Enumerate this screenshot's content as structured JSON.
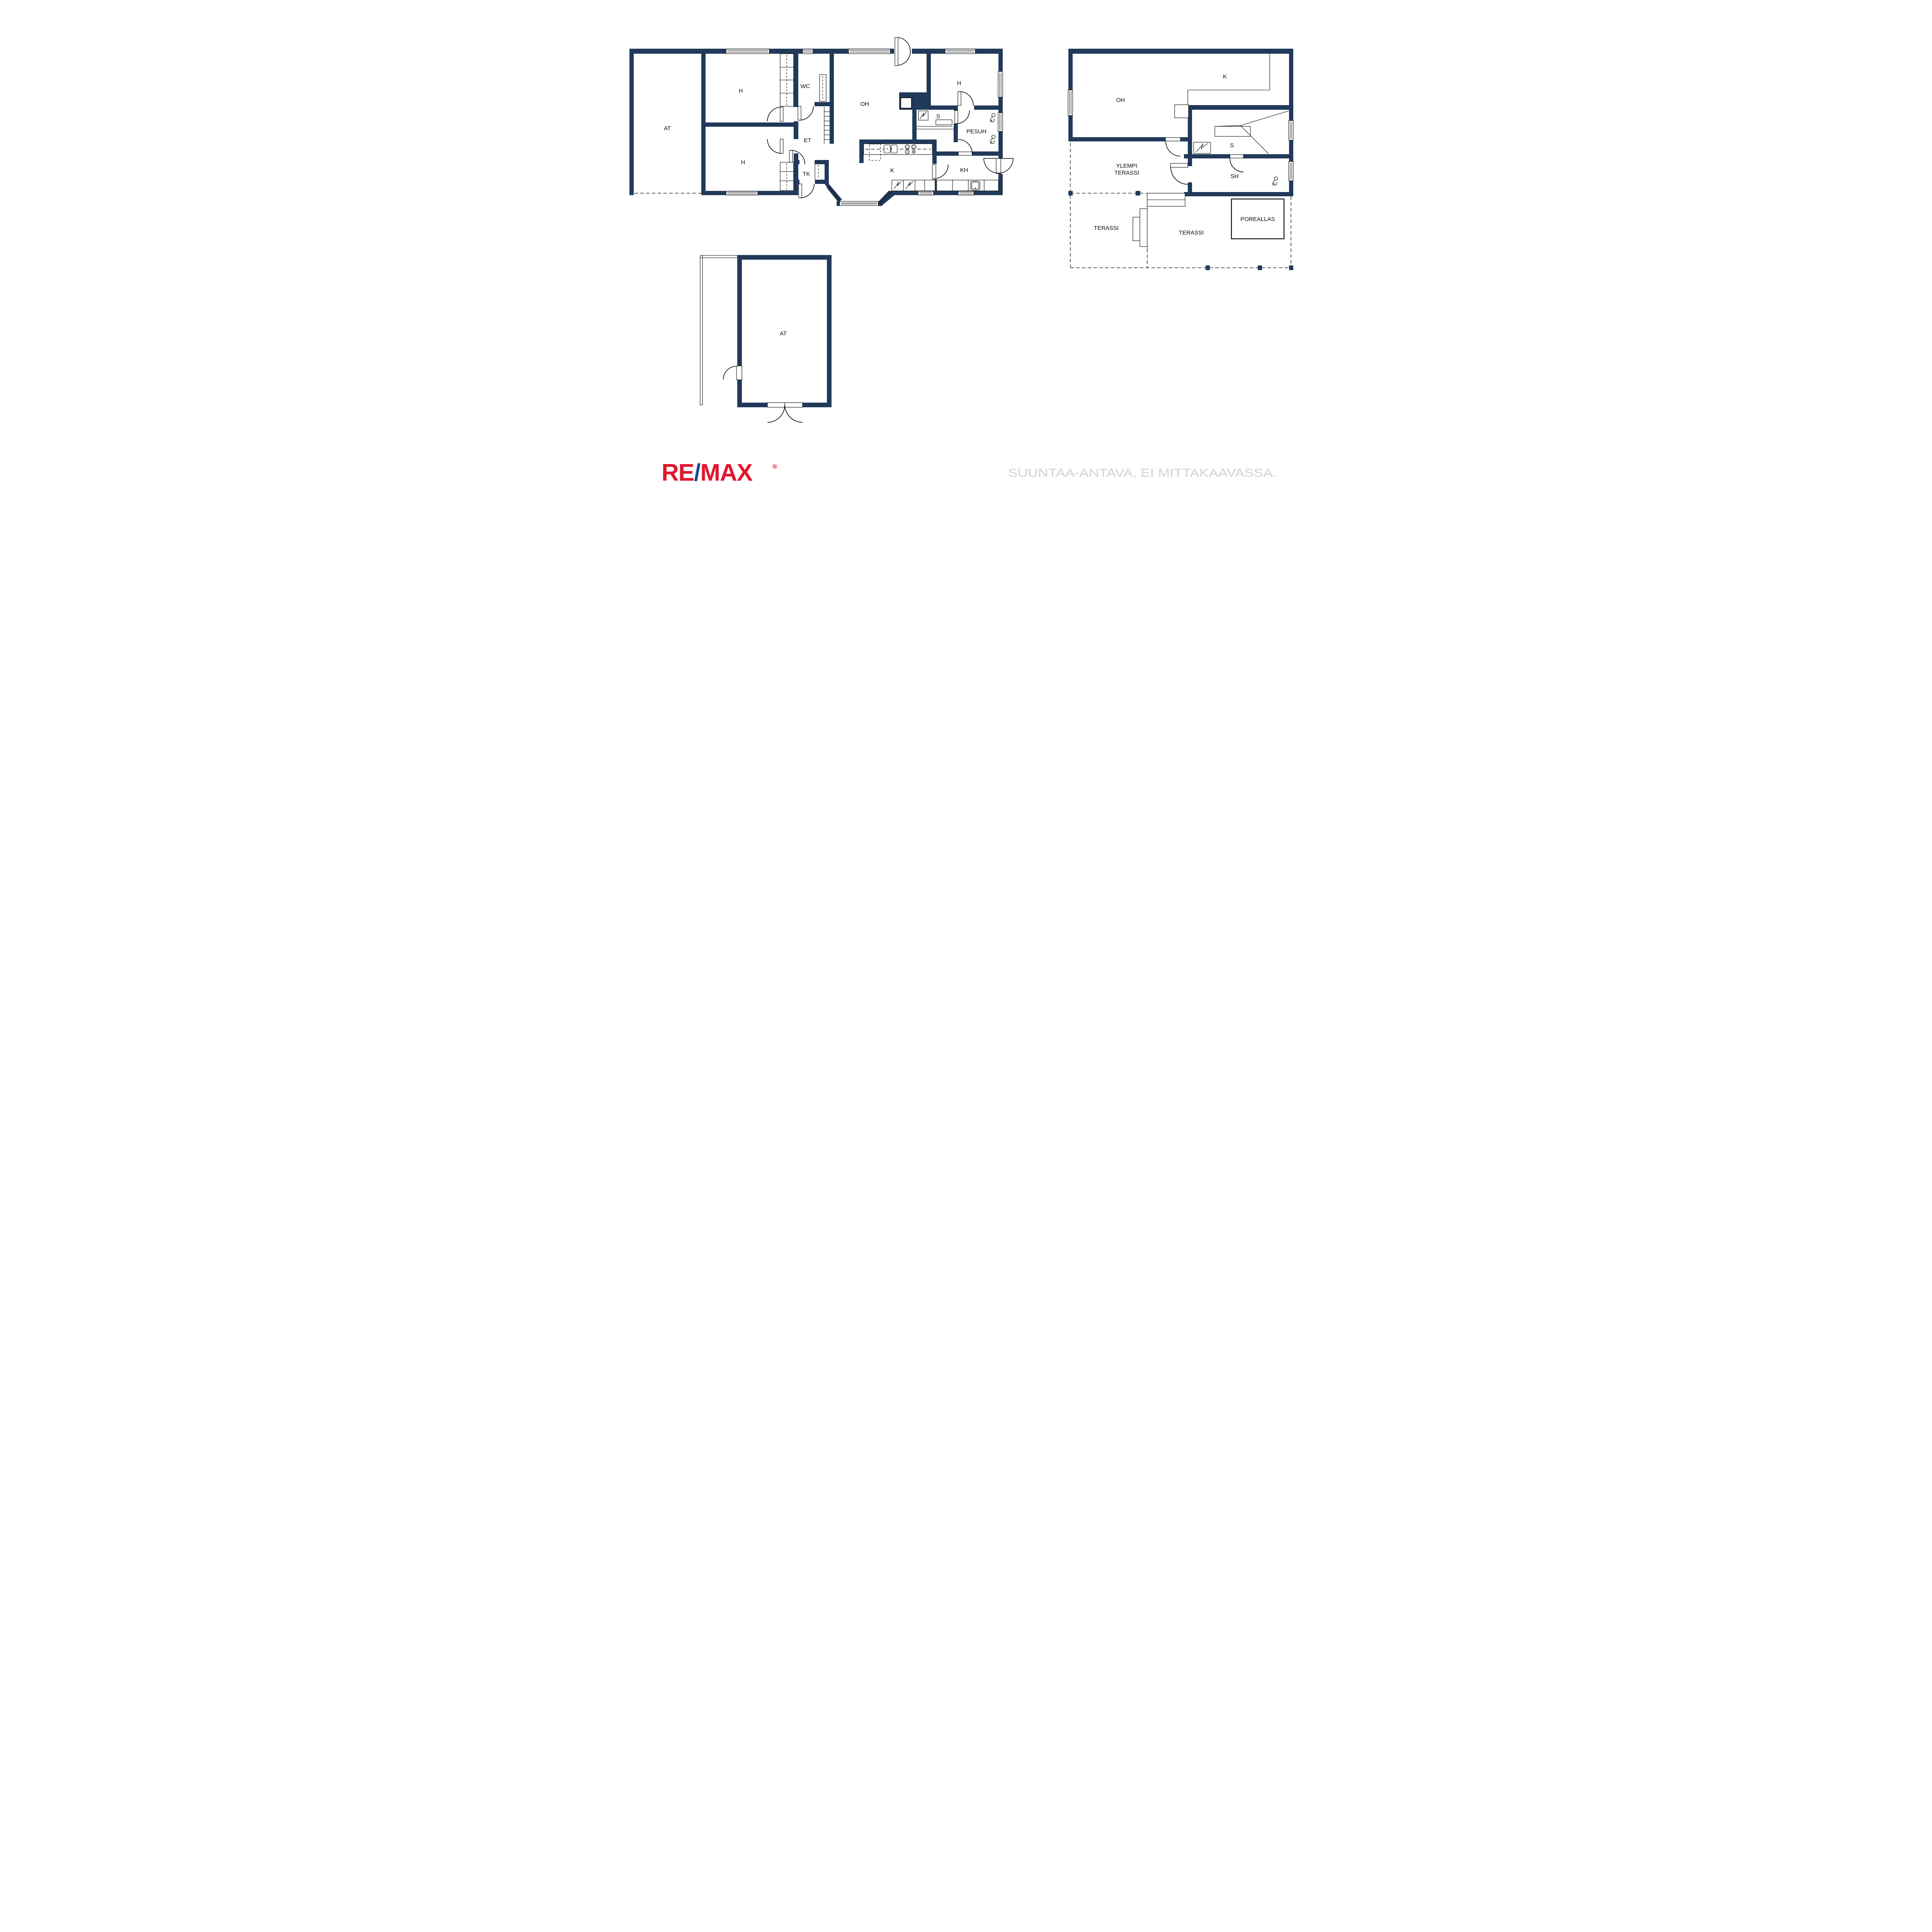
{
  "document": {
    "type": "real-estate floor plan sheet",
    "floors": [
      "main floor",
      "upper floor",
      "garage"
    ]
  },
  "colors": {
    "wall_navy": "#21395a",
    "line_black": "#000000",
    "logo_red": "#e0172f",
    "logo_blue": "#164a9c",
    "disclaimer_gray": "#d2d2d2",
    "appliance_gray": "#d9d9d9",
    "background": "#ffffff"
  },
  "floor1": {
    "name": "main floor plan",
    "rooms": [
      {
        "id": "at",
        "label": "AT"
      },
      {
        "id": "h1",
        "label": "H"
      },
      {
        "id": "h2",
        "label": "H"
      },
      {
        "id": "wc",
        "label": "WC"
      },
      {
        "id": "et",
        "label": "ET"
      },
      {
        "id": "tk",
        "label": "TK"
      },
      {
        "id": "oh",
        "label": "OH"
      },
      {
        "id": "h3",
        "label": "H"
      },
      {
        "id": "k",
        "label": "K"
      },
      {
        "id": "s",
        "label": "S"
      },
      {
        "id": "pesuh",
        "label": "PESUH"
      },
      {
        "id": "kh",
        "label": "KH"
      }
    ]
  },
  "floor2": {
    "name": "upper floor plan",
    "rooms": [
      {
        "id": "oh2",
        "label": "OH"
      },
      {
        "id": "k2",
        "label": "K"
      },
      {
        "id": "s2",
        "label": "S"
      },
      {
        "id": "sh",
        "label": "SH"
      },
      {
        "id": "poreallas",
        "label": "POREALLAS"
      }
    ],
    "terraces": {
      "upper_line1": "YLEMPI",
      "upper_line2": "TERASSI",
      "lower_left": "TERASSI",
      "lower_mid": "TERASSI"
    }
  },
  "garage": {
    "name": "garage plan",
    "room_label": "AT"
  },
  "icons": {
    "sauna_stove": "square-with-zigzag",
    "fireplace": "navy-block-with-white-hearth",
    "shower": "shower-head-with-hose",
    "kitchen_sink": "double-basin",
    "stove_burners": "four-circles",
    "washing_machine": "square-with-zigzag",
    "laundry_basin": "rounded-square-basin",
    "stairs": "tread-lines",
    "door": "quarter-circle-swing",
    "double_door": "half-circle-swing",
    "window": "white-gap-with-lines",
    "pool": "thin-outline-rectangle",
    "post": "small-navy-square"
  },
  "footer": {
    "logo": {
      "re": "RE",
      "slash": "/",
      "max": "MAX",
      "registered": "®"
    },
    "disclaimer": "SUUNTAA-ANTAVA, EI MITTAKAAVASSA."
  }
}
